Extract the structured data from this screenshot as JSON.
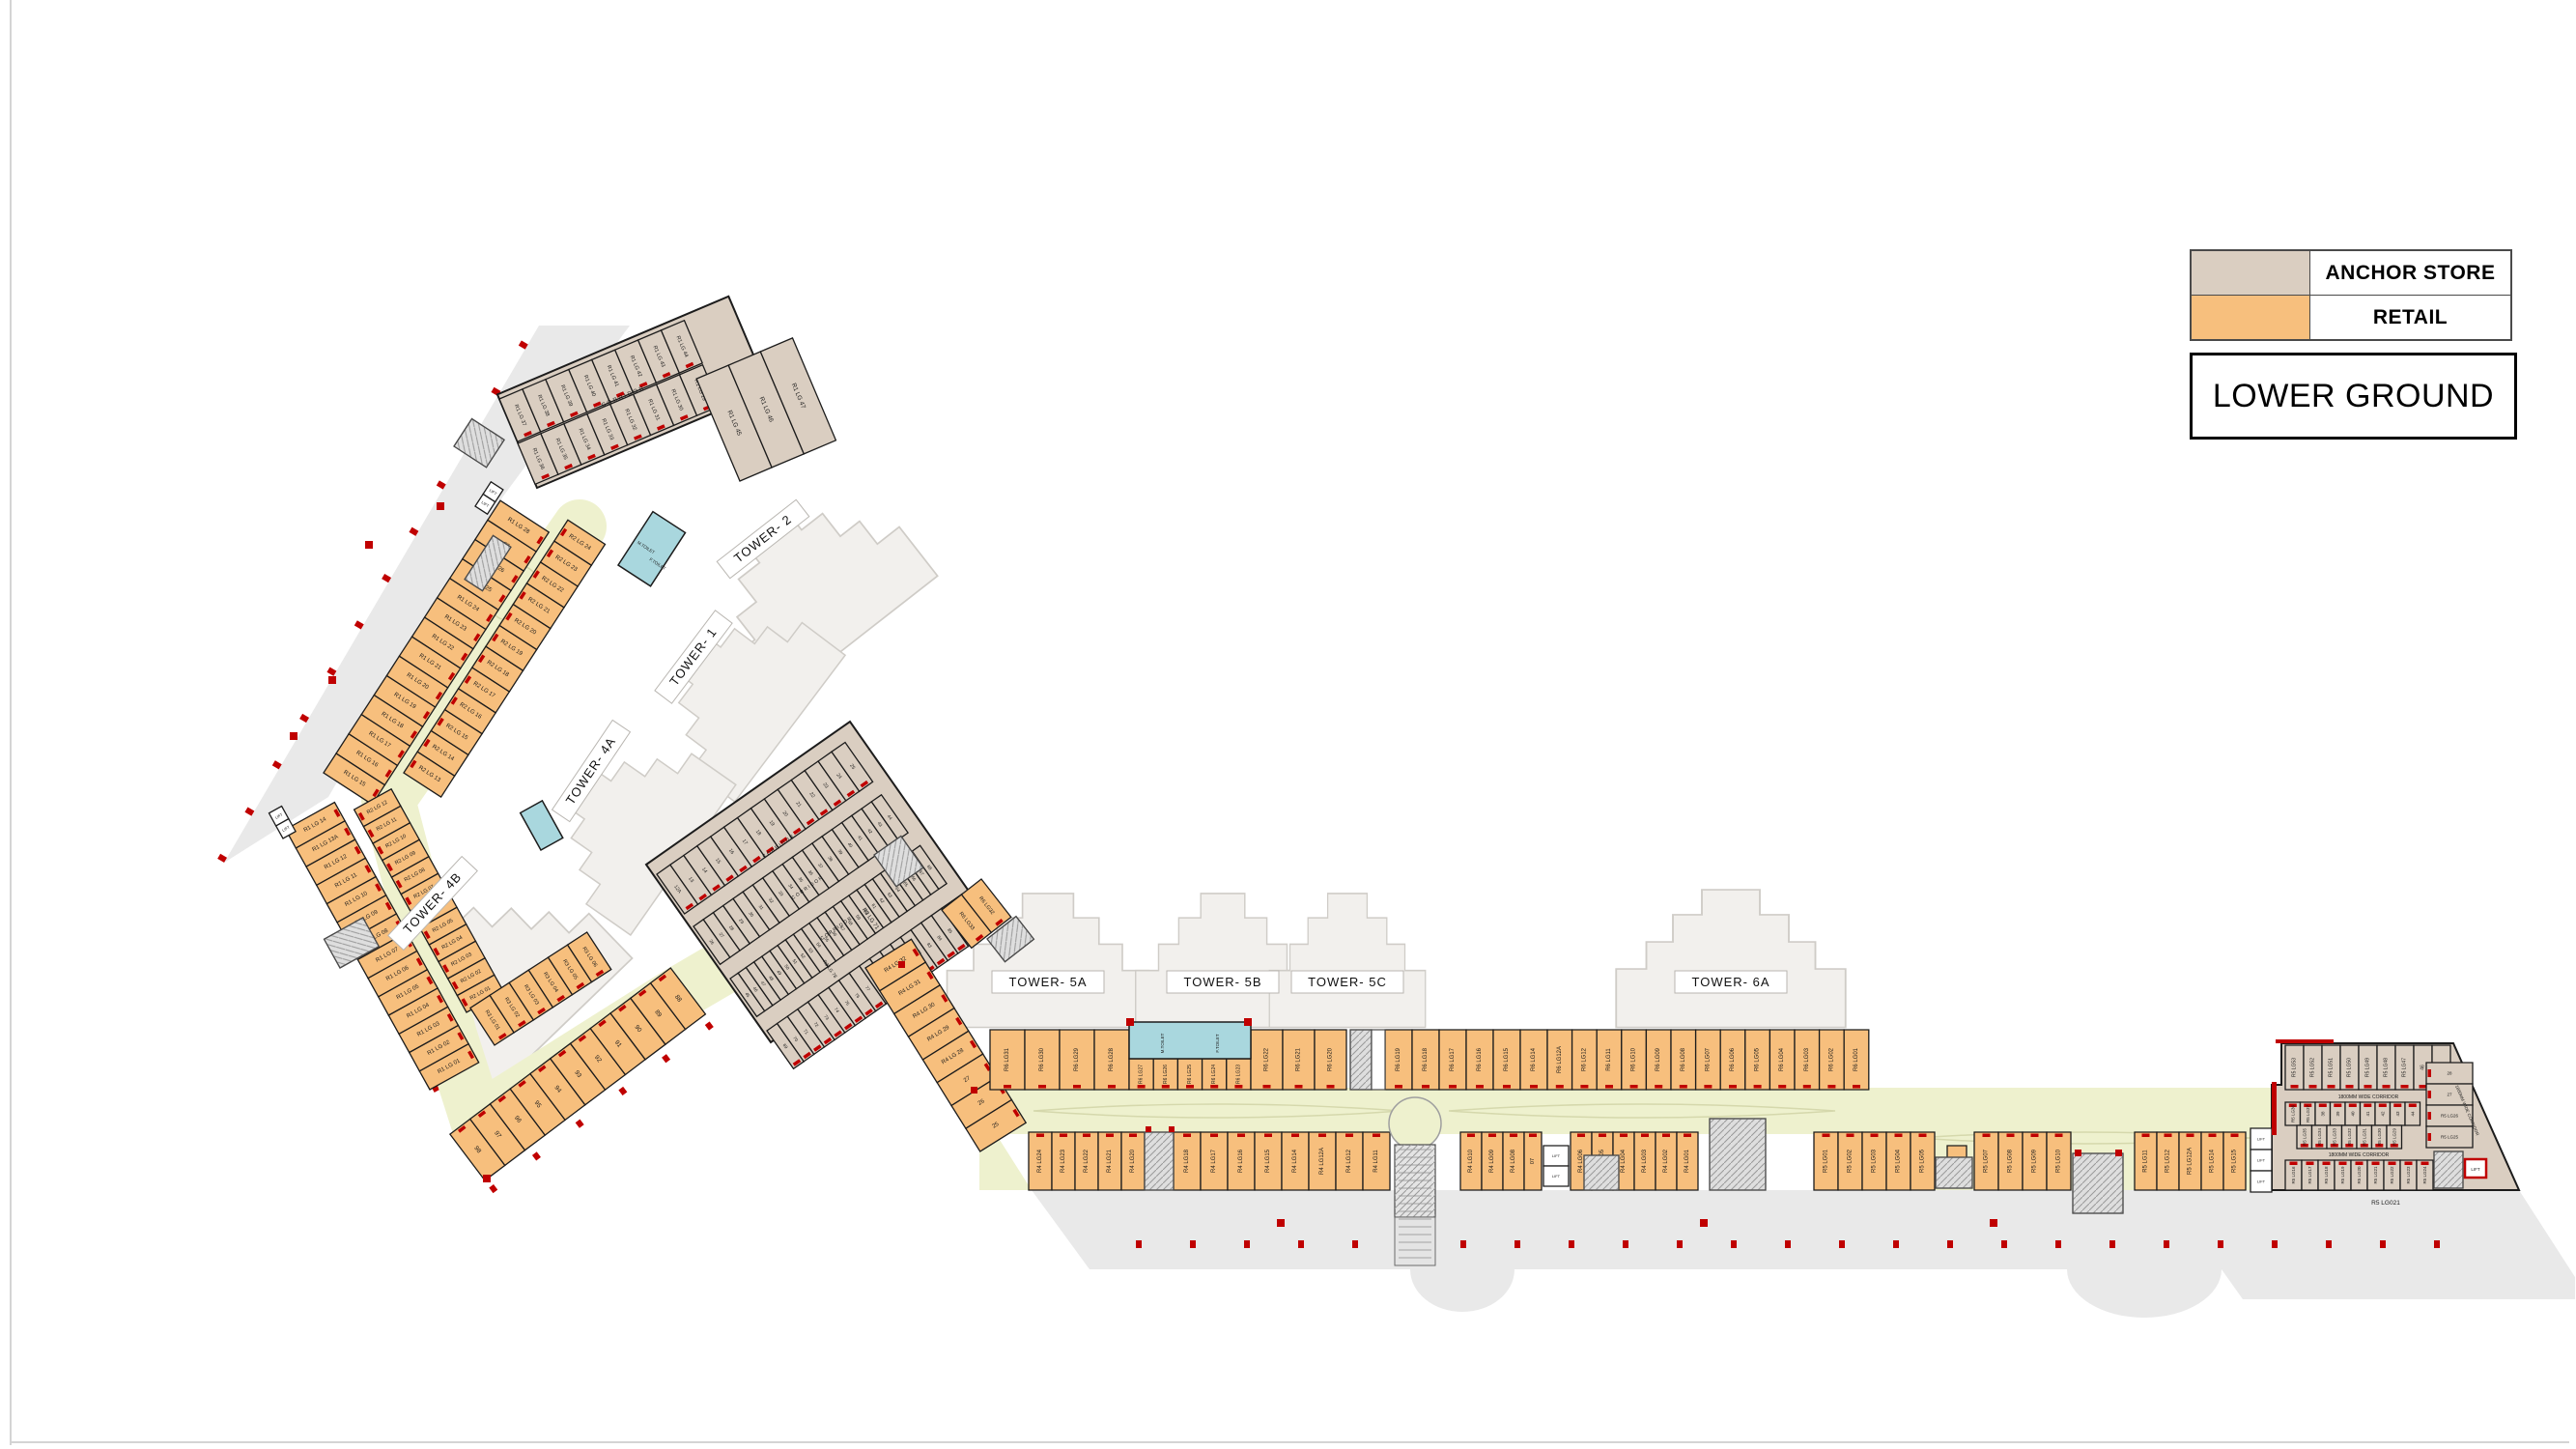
{
  "title": "LOWER GROUND",
  "legend": {
    "anchor_label": "ANCHOR STORE",
    "retail_label": "RETAIL"
  },
  "colors": {
    "anchor": "#DACEC1",
    "retail": "#F7BF7D",
    "corridor": "#EEF1CE",
    "toilet": "#A9D7DE",
    "tower": "#F2F0ED",
    "parking": "#E9E9E9",
    "white": "#FFFFFF",
    "red": "#C00000",
    "wall": "#1C1C1C"
  },
  "towers": {
    "t1": "TOWER- 1",
    "t2": "TOWER- 2",
    "t4a": "TOWER- 4A",
    "t4b": "TOWER- 4B",
    "t5a": "TOWER- 5A",
    "t5b": "TOWER- 5B",
    "t5c": "TOWER- 5C",
    "t6a": "TOWER- 6A"
  },
  "labels": {
    "corridor": "CORRIDOR",
    "wide_corridor": "1800MM WIDE CORRIDOR",
    "m_toilet": "M.TOILET",
    "f_toilet": "F.TOILET",
    "lift": "LIFT",
    "caption_right": "R5 LG021",
    "r3_71": "R3 LG 71",
    "r3_78": "R3 LG 78"
  },
  "rows": {
    "left": {
      "r1_upper": [
        "R1 LG 15",
        "R1 LG 16",
        "R1 LG 17",
        "R1 LG 18",
        "R1 LG 19",
        "R1 LG 20",
        "R1 LG 21",
        "R1 LG 22",
        "R1 LG 23",
        "R1 LG 24",
        "R1 LG 25",
        "R1 LG 26",
        "27",
        "R1 LG 28"
      ],
      "r1_lower": [
        "R1 LG 01",
        "R1 LG 02",
        "R1 LG 03",
        "R1 LG 04",
        "R1 LG 05",
        "R1 LG 06",
        "R1 LG 07",
        "R1 LG 08",
        "R1 LG 09",
        "R1 LG 10",
        "R1 LG 11",
        "R1 LG 12",
        "R1 LG 13A",
        "R1 LG 14"
      ],
      "r2_upper": [
        "R2 LG 13",
        "R2 LG 14",
        "R2 LG 15",
        "R2 LG 16",
        "R2 LG 17",
        "R2 LG 18",
        "R2 LG 19",
        "R2 LG 20",
        "R2 LG 21",
        "R2 LG 22",
        "R2 LG 23",
        "R2 LG 24"
      ],
      "r2_lower": [
        "R2 LG 01",
        "R2 LG 02",
        "R2 LG 03",
        "R2 LG 04",
        "R2 LG 05",
        "R2 LG 06",
        "R2 LG 07",
        "R2 LG 08",
        "R2 LG 09",
        "R2 LG 10",
        "R2 LG 11",
        "R2 LG 12"
      ],
      "r3": [
        "R3 LG 01",
        "R3 LG 02",
        "R3 LG 03",
        "R3 LG 04",
        "R3 LG 05",
        "R3 LG 06"
      ],
      "corner": [
        "98",
        "97",
        "96",
        "95",
        "94",
        "93",
        "92",
        "91",
        "90",
        "89",
        "88"
      ],
      "anchor_outer": [
        "R1 LG 37",
        "R1 LG 38",
        "R1 LG 39",
        "R1 LG 40",
        "R1 LG 41",
        "R1 LG 42",
        "R1 LG 43",
        "R1 LG 44"
      ],
      "anchor_inner": [
        "R1 LG 36",
        "R1 LG 35",
        "R1 LG 34",
        "R1 LG 33",
        "R1 LG 32",
        "R1 LG 31",
        "R1 LG 30",
        "R1 LG 29"
      ],
      "anchor_big": [
        "R1 LG 45",
        "R1 LG 46",
        "R1 LG 47"
      ],
      "lift_pair": [
        "LIFT",
        "LIFT"
      ]
    },
    "mid": {
      "row1": [
        "12A",
        "13",
        "14",
        "15",
        "16",
        "17",
        "18",
        "19",
        "20",
        "21",
        "22",
        "23",
        "24",
        "25"
      ],
      "row2": [
        "26",
        "27",
        "28",
        "29",
        "30",
        "31",
        "32",
        "33",
        "34",
        "35",
        "36",
        "37",
        "38",
        "39",
        "40",
        "41",
        "42",
        "43",
        "44"
      ],
      "row3": [
        "45",
        "46",
        "47",
        "48",
        "49",
        "50",
        "51",
        "52",
        "53",
        "54",
        "55",
        "56",
        "57",
        "58",
        "59",
        "60",
        "61",
        "62",
        "63",
        "64",
        "65",
        "66",
        "67",
        "68"
      ],
      "row4": [
        "69",
        "70",
        "71",
        "72",
        "73",
        "74",
        "75",
        "76",
        "77",
        "78",
        "79",
        "80",
        "81",
        "82",
        "83",
        "84",
        "85",
        "86",
        "87"
      ]
    },
    "right": {
      "bend_top": [
        "R6 LG33",
        "R6 LG32"
      ],
      "bend": [
        "R4 LG 32",
        "R4 LG 31",
        "R4 LG 30",
        "R4 LG 29",
        "R4 LG 28",
        "27",
        "26",
        "25"
      ],
      "uA": [
        "R6 LG31",
        "R6 LG30",
        "R6 LG29",
        "R6 LG28"
      ],
      "u_toilet_front": [
        "R6 LG27",
        "R6 LG26",
        "R6 LG25",
        "R6 LG24",
        "R6 LG23"
      ],
      "uB": [
        "R6 LG22",
        "R6 LG21",
        "R6 LG20"
      ],
      "uC": [
        "R6 LG19",
        "R6 LG18",
        "R6 LG17",
        "R6 LG16",
        "R6 LG15",
        "R6 LG14"
      ],
      "uD": [
        "R6 LG12A",
        "R6 LG12",
        "R6 LG11",
        "R6 LG10",
        "R6 LG09",
        "R6 LG08",
        "R6 LG07",
        "R6 LG06",
        "R6 LG05",
        "R6 LG04",
        "R6 LG03",
        "R6 LG02",
        "R6 LG01"
      ],
      "lA": [
        "R4 LG24",
        "R4 LG23",
        "R4 LG22",
        "R4 LG21",
        "R4 LG20"
      ],
      "lB": [
        "R4 LG18",
        "R4 LG17",
        "R4 LG16",
        "R4 LG15",
        "R4 LG14",
        "R4 LG12A",
        "R4 LG12",
        "R4 LG11"
      ],
      "lC": [
        "R4 LG10",
        "R4 LG09",
        "R4 LG08"
      ],
      "l07": [
        "07"
      ],
      "lD": [
        "R4 LG06",
        "R4 LG05",
        "R4 LG04",
        "R4 LG03",
        "R4 LG02",
        "R4 LG01"
      ],
      "lE": [
        "R5 LG01",
        "R5 LG02",
        "R5 LG03",
        "R5 LG04",
        "R5 LG05"
      ],
      "l06": [
        "06"
      ],
      "lF": [
        "R5 LG07",
        "R5 LG08",
        "R5 LG09",
        "R5 LG10"
      ],
      "lG": [
        "R5 LG11",
        "R5 LG12",
        "R5 LG12A",
        "R5 LG14",
        "R5 LG15"
      ],
      "lift_col": [
        "LIFT",
        "LIFT",
        "LIFT"
      ],
      "lift_pair": [
        "LIFT",
        "LIFT"
      ]
    },
    "far": {
      "row1": [
        "R5 LG53",
        "R5 LG52",
        "R5 LG51",
        "R5 LG50",
        "R5 LG49",
        "R5 LG48",
        "R5 LG47",
        "46",
        "45"
      ],
      "row2": [
        "R5 LG36",
        "R5 LG37",
        "38",
        "39",
        "40",
        "41",
        "42",
        "43",
        "44"
      ],
      "row3": [
        "R5 LG35",
        "R5 LG34",
        "R5 LG33",
        "R5 LG32",
        "R5 LG31",
        "R5 LG30",
        "R5 LG29"
      ],
      "row4": [
        "R5 LG16",
        "R5 LG17",
        "R5 LG18",
        "R5 LG19",
        "R5 LG20",
        "R5 LG21",
        "R5 LG22",
        "R5 LG23",
        "R5 LG24"
      ],
      "side": [
        "28",
        "27",
        "R5 LG26",
        "R5 LG25"
      ]
    }
  }
}
